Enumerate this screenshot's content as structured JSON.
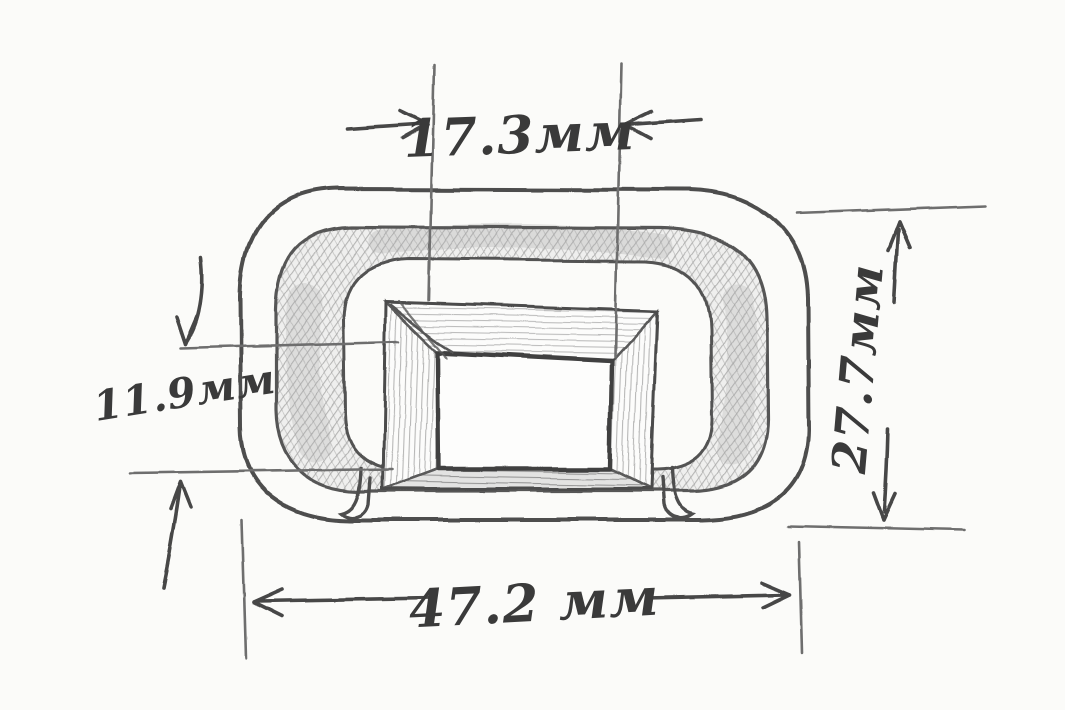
{
  "page": {
    "background": "#fbfbf9",
    "pencil_line_color": "#4c4c4c",
    "light_line_color": "#6e6e6e",
    "shading_color": "#8f8f8f",
    "text_color": "#3a3a3a"
  },
  "dimensions": {
    "inner_window_width": {
      "label": "17.3мм",
      "value": 17.3,
      "unit": "мм"
    },
    "rim_edge_height": {
      "label": "11.9мм",
      "value": 11.9,
      "unit": "мм"
    },
    "overall_height": {
      "label": "27.7мм",
      "value": 27.7,
      "unit": "мм"
    },
    "overall_width": {
      "label": "47.2 мм",
      "value": 47.2,
      "unit": "мм"
    }
  }
}
